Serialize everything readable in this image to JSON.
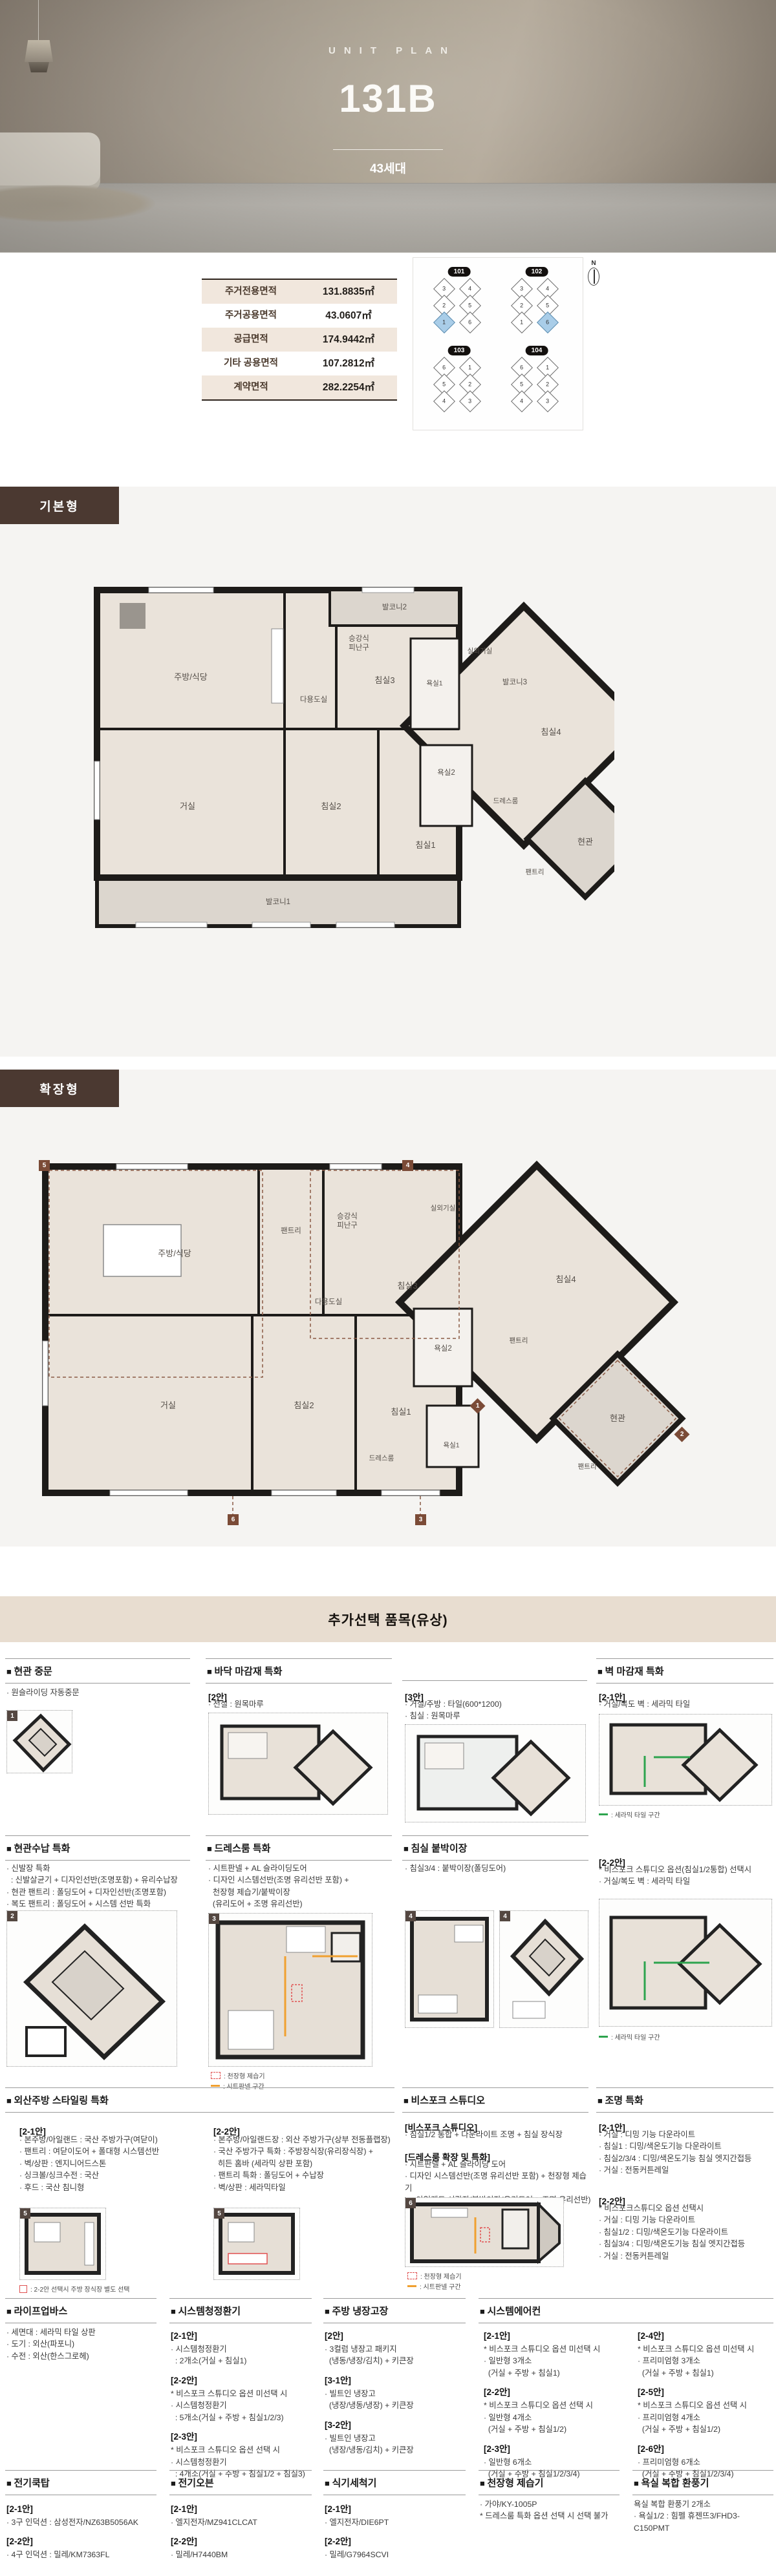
{
  "hero": {
    "eyebrow": "UNIT PLAN",
    "title": "131B",
    "units_badge": "43세대"
  },
  "area_table": {
    "rows": [
      {
        "label": "주거전용면적",
        "value": "131.8835㎡"
      },
      {
        "label": "주거공용면적",
        "value": "43.0607㎡"
      },
      {
        "label": "공급면적",
        "value": "174.9442㎡"
      },
      {
        "label": "기타 공용면적",
        "value": "107.2812㎡"
      },
      {
        "label": "계약면적",
        "value": "282.2254㎡"
      }
    ]
  },
  "site_map": {
    "north_label": "N",
    "buildings": [
      {
        "name": "101",
        "units": [
          "3",
          "4",
          "2",
          "5",
          "1",
          "6"
        ]
      },
      {
        "name": "102",
        "units": [
          "3",
          "4",
          "2",
          "5",
          "1",
          "6"
        ]
      },
      {
        "name": "103",
        "units": [
          "6",
          "1",
          "5",
          "2",
          "4",
          "3"
        ]
      },
      {
        "name": "104",
        "units": [
          "6",
          "1",
          "5",
          "2",
          "4",
          "3"
        ]
      }
    ]
  },
  "plans": [
    {
      "tab": "기본형",
      "rooms": [
        "주방/식당",
        "다용도실",
        "승강식\n피난구",
        "발코니2",
        "침실3",
        "욕실1",
        "실외기실",
        "발코니3",
        "침실4",
        "욕실2",
        "드레스룸",
        "현관",
        "팬트리",
        "거실",
        "침실2",
        "침실1",
        "발코니1"
      ]
    },
    {
      "tab": "확장형",
      "rooms": [
        "주방/식당",
        "팬트리",
        "승강식\n피난구",
        "실외기실",
        "침실4",
        "침실3",
        "다용도실",
        "욕실2",
        "팬트리",
        "현관",
        "팬트리",
        "거실",
        "침실2",
        "침실1",
        "욕실1",
        "드레스룸"
      ],
      "markers": [
        "5",
        "4",
        "1",
        "2",
        "6",
        "3"
      ]
    }
  ],
  "options": {
    "banner": "추가선택 품목(유상)",
    "legend": {
      "dehumidifier": ": 천장형 제습기",
      "sheet_panel": ": 시트판넬 구간",
      "ceramic_tile": ": 세라믹 타일 구간",
      "kitchen_note": ": 2-2안 선택시 주방 장식장 별도 선택"
    },
    "sections": [
      {
        "title": "현관 중문",
        "badge": "1",
        "lines": [
          "· 원슬라이딩 자동중문"
        ]
      },
      {
        "title": "바닥 마감재 특화",
        "p1": {
          "head": "[2안]",
          "lines": [
            "· 전실 : 원목마루"
          ]
        },
        "p2": {
          "head": "[3안]",
          "lines": [
            "· 거실/주방 : 타일(600*1200)",
            "· 침실 : 원목마루"
          ]
        }
      },
      {
        "title": "벽 마감재 특화",
        "p1": {
          "head": "[2-1안]",
          "lines": [
            "· 거실/복도 벽 : 세라믹 타일"
          ]
        },
        "p2": {
          "head": "[2-2안]",
          "lines": [
            "* 비스포크 스튜디오 옵션(침실1/2통합) 선택시",
            "· 거실/복도 벽 : 세라믹 타일"
          ]
        }
      },
      {
        "title": "현관수납 특화",
        "badge": "2",
        "lines": [
          "· 신발장 특화",
          "  : 신발살균기 + 디자인선반(조명포함) + 유리수납장",
          "· 현관 팬트리 : 폴딩도어 + 디자인선반(조명포함)",
          "· 복도 팬트리 : 폴딩도어 + 시스템 선반 특화"
        ]
      },
      {
        "title": "드레스룸 특화",
        "badge": "3",
        "lines": [
          "· 시트판넬 + AL 슬라이딩도어",
          "· 디자인 시스템선반(조명 유리선반 포함) +",
          "  천장형 제습기/붙박이장",
          "  (유리도어 + 조명 유리선반)"
        ]
      },
      {
        "title": "침실 붙박이장",
        "badge": "4",
        "lines": [
          "· 침실3/4 : 붙박이장(폴딩도어)"
        ]
      },
      {
        "title": "외산주방 스타일링 특화",
        "badge": "5",
        "p1": {
          "head": "[2-1안]",
          "lines": [
            "· 본주방/아일랜드 : 국산 주방가구(여닫이)",
            "· 팬트리 : 여닫이도어 + 폴대형 시스템선반",
            "· 벽/상판 : 엔지니어드스톤",
            "· 싱크볼/싱크수전 : 국산",
            "· 후드 : 국산 침니형"
          ]
        },
        "p2": {
          "head": "[2-2안]",
          "lines": [
            "· 본주방/아일랜드장 : 외산 주방가구(상부 전동플랩장)",
            "· 국산 주방가구 특화 : 주방장식장(유리장식장) +",
            "  히든 홈바 (세라믹 상판 포함)",
            "· 팬트리 특화 : 폴딩도어 + 수납장",
            "· 벽/상판 : 세라믹타일"
          ]
        }
      },
      {
        "title": "비스포크 스튜디오",
        "badge": "6",
        "p1": {
          "head": "[비스포크 스튜디오]",
          "lines": [
            "· 침실1/2 통합 + 다운라이트 조명 + 침실 장식장"
          ]
        },
        "p2": {
          "head": "[드레스룸 확장 및 특화]",
          "lines": [
            "· 시트판넬 + AL 슬라이딩 도어",
            "· 디자인 시스템선반(조명 유리선반 포함) + 천장형 제습기",
            "  + 아일랜드 서랍장/붙박이장(유리도어 + 조명 유리선반)"
          ]
        }
      },
      {
        "title": "조명 특화",
        "p1": {
          "head": "[2-1안]",
          "lines": [
            "· 거실 : 디밍 기능 다운라이트",
            "· 침실1 : 디밍/색온도기능 다운라이트",
            "· 침실2/3/4 : 디밍/색온도기능 침실 엣지간접등",
            "· 거실 : 전동커튼레일"
          ]
        },
        "p2": {
          "head": "[2-2안]",
          "lines": [
            "* 비스포크스튜디오 옵션 선택시",
            "· 거실 : 디밍 기능 다운라이트",
            "· 침실1/2 : 디밍/색온도기능 다운라이트",
            "· 침실3/4 : 디밍/색온도기능 침실 엣지간접등",
            "· 거실 : 전동커튼레일"
          ]
        }
      },
      {
        "title": "라이프업바스",
        "lines": [
          "· 세면대 : 세라믹 타일 상판",
          "· 도기 : 외산(파포니)",
          "· 수전 : 외산(한스그로헤)"
        ]
      },
      {
        "title": "시스템청정환기",
        "groups": [
          {
            "head": "[2-1안]",
            "lines": [
              "· 시스템청정환기",
              "  : 2개소(거실 + 침실1)"
            ]
          },
          {
            "head": "[2-2안]",
            "lines": [
              "* 비스포크 스튜디오 옵션 미선택 시",
              "· 시스템청정환기",
              "  : 5개소(거실 + 주방 + 침실1/2/3)"
            ]
          },
          {
            "head": "[2-3안]",
            "lines": [
              "* 비스포크 스튜디오 옵션 선택 시",
              "· 시스템청정환기",
              "  : 4개소(거실 + 주방 + 침실1/2 + 침실3)"
            ]
          }
        ]
      },
      {
        "title": "주방 냉장고장",
        "groups": [
          {
            "head": "[2안]",
            "lines": [
              "· 3컬럼 냉장고 패키지",
              "  (냉동/냉장/김치) + 키큰장"
            ]
          },
          {
            "head": "[3-1안]",
            "lines": [
              "· 빌트인 냉장고",
              "  (냉장/냉동/냉장) + 키큰장"
            ]
          },
          {
            "head": "[3-2안]",
            "lines": [
              "· 빌트인 냉장고",
              "  (냉장/냉동/김치) + 키큰장"
            ]
          }
        ]
      },
      {
        "title": "시스템에어컨",
        "col_a": [
          {
            "head": "[2-1안]",
            "lines": [
              "* 비스포크 스튜디오 옵션 미선택 시",
              "· 일반형 3개소",
              "  (거실 + 주방 + 침실1)"
            ]
          },
          {
            "head": "[2-2안]",
            "lines": [
              "* 비스포크 스튜디오 옵션 선택 시",
              "· 일반형 4개소",
              "  (거실 + 주방 + 침실1/2)"
            ]
          },
          {
            "head": "[2-3안]",
            "lines": [
              "· 일반형 6개소",
              "  (거실 + 주방 + 침실1/2/3/4)"
            ]
          }
        ],
        "col_b": [
          {
            "head": "[2-4안]",
            "lines": [
              "* 비스포크 스튜디오 옵션 미선택 시",
              "· 프리미엄형 3개소",
              "  (거실 + 주방 + 침실1)"
            ]
          },
          {
            "head": "[2-5안]",
            "lines": [
              "* 비스포크 스튜디오 옵션 선택 시",
              "· 프리미엄형 4개소",
              "  (거실 + 주방 + 침실1/2)"
            ]
          },
          {
            "head": "[2-6안]",
            "lines": [
              "· 프리미엄형 6개소",
              "  (거실 + 주방 + 침실1/2/3/4)"
            ]
          }
        ]
      },
      {
        "title": "전기쿡탑",
        "groups": [
          {
            "head": "[2-1안]",
            "lines": [
              "· 3구 인덕션 : 삼성전자/NZ63B5056AK"
            ]
          },
          {
            "head": "[2-2안]",
            "lines": [
              "· 4구 인덕션 : 밀레/KM7363FL"
            ]
          }
        ]
      },
      {
        "title": "전기오븐",
        "groups": [
          {
            "head": "[2-1안]",
            "lines": [
              "· 엘지전자/MZ941CLCAT"
            ]
          },
          {
            "head": "[2-2안]",
            "lines": [
              "· 밀레/H7440BM"
            ]
          }
        ]
      },
      {
        "title": "식기세척기",
        "groups": [
          {
            "head": "[2-1안]",
            "lines": [
              "· 엘지전자/DIE6PT"
            ]
          },
          {
            "head": "[2-2안]",
            "lines": [
              "· 밀레/G7964SCVI"
            ]
          }
        ]
      },
      {
        "title": "천장형 제습기",
        "lines": [
          "· 가야/KY-1005P",
          "* 드레스룸 특화 옵션 선택 시 선택 불가"
        ]
      },
      {
        "title": "욕실 복합 환풍기",
        "lines": [
          "욕실 복합 환풍기 2개소",
          "· 욕실1/2 : 힘펠 휴젠뜨3/FHD3-C150PMT"
        ]
      }
    ]
  }
}
